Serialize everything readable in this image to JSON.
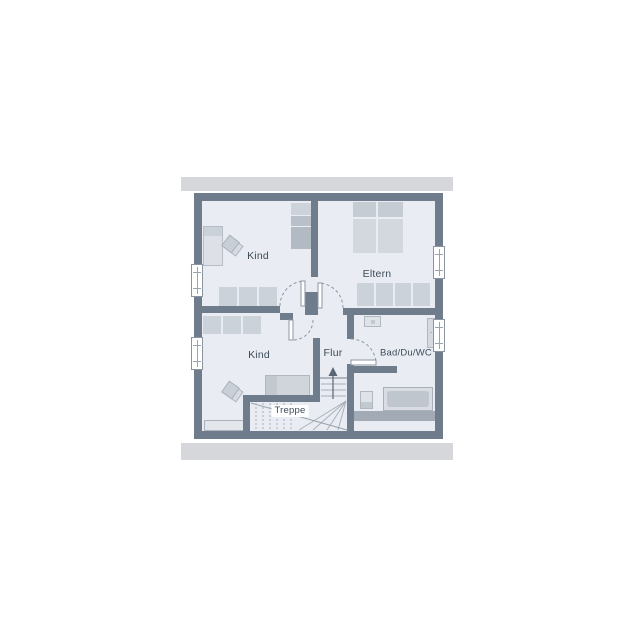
{
  "drawing": {
    "type": "floor-plan",
    "storey": "upper-floor"
  },
  "rooms": {
    "kind_top": {
      "label": "Kind"
    },
    "eltern": {
      "label": "Eltern"
    },
    "kind_bottom": {
      "label": "Kind"
    },
    "flur": {
      "label": "Flur"
    },
    "bad": {
      "label": "Bad/Du/WC"
    },
    "treppe": {
      "label": "Treppe"
    }
  },
  "symbols": [
    "single-bed",
    "double-bed",
    "wardrobe",
    "cabinet-row",
    "desk-chair",
    "sink",
    "shower-radiator",
    "wc",
    "bathtub",
    "stair-run",
    "stair-winder",
    "stair-up-arrow",
    "door-swing-arc",
    "window"
  ],
  "colors": {
    "wall": "#6f7c8c",
    "floor": "#e9edf3",
    "roof_band": "#d5d7da",
    "furniture_light": "#ccd2d9",
    "furniture_dark": "#b7bec7",
    "knee_wall": "#a2aab5",
    "stair_line": "#a8b0ba",
    "text": "#3e4b58"
  }
}
